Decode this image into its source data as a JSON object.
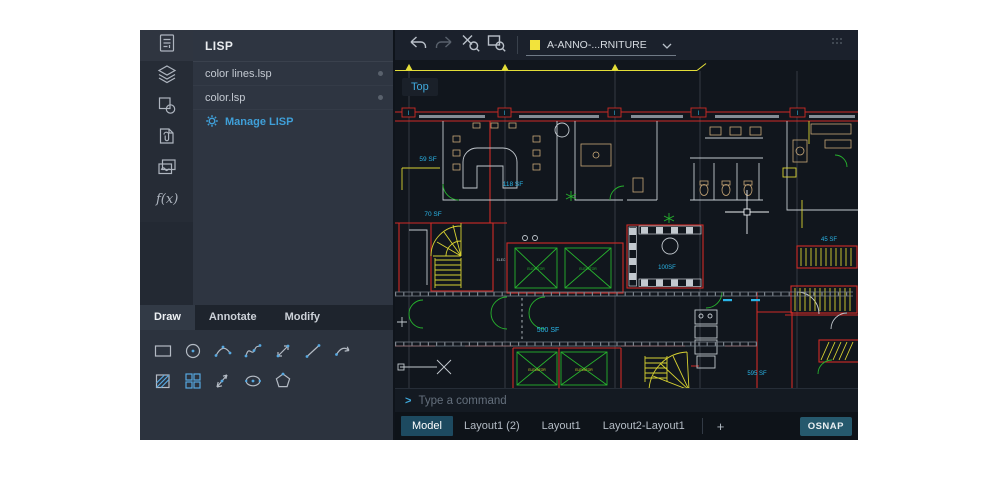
{
  "rail": {
    "fx_label": "f(x)"
  },
  "lisp_panel": {
    "title": "LISP",
    "items": [
      {
        "label": "color lines.lsp"
      },
      {
        "label": "color.lsp"
      }
    ],
    "manage_label": "Manage LISP"
  },
  "ribbon": {
    "tabs": [
      {
        "label": "Draw"
      },
      {
        "label": "Annotate"
      },
      {
        "label": "Modify"
      }
    ]
  },
  "toolbar": {
    "layer_name": "A-ANNO-...RNITURE"
  },
  "viewport": {
    "view_label": "Top",
    "grid_bubble": "I",
    "elevator_label": "ELEVATOR",
    "elec_label": "ELEC",
    "room_labels": {
      "sf59": "59 SF",
      "sf118": "118 SF",
      "sf70": "70 SF",
      "sf100": "100SF",
      "sf500": "500 SF",
      "sf595": "595 SF",
      "sf45": "45 SF"
    }
  },
  "command_bar": {
    "prompt": ">",
    "placeholder": "Type a command"
  },
  "layout_bar": {
    "tabs": [
      {
        "label": "Model"
      },
      {
        "label": "Layout1 (2)"
      },
      {
        "label": "Layout1"
      },
      {
        "label": "Layout2-Layout1"
      }
    ],
    "add_label": "+",
    "osnap_label": "OSNAP"
  },
  "colors": {
    "accent": "#3f9fd8",
    "layer_swatch": "#f2e33c",
    "wall_red": "#cf2b26",
    "elevator_green": "#27b32e",
    "label_cyan": "#2ab5e8",
    "stair_yellow": "#d8d232",
    "model_tab_bg": "#1d4a60"
  }
}
